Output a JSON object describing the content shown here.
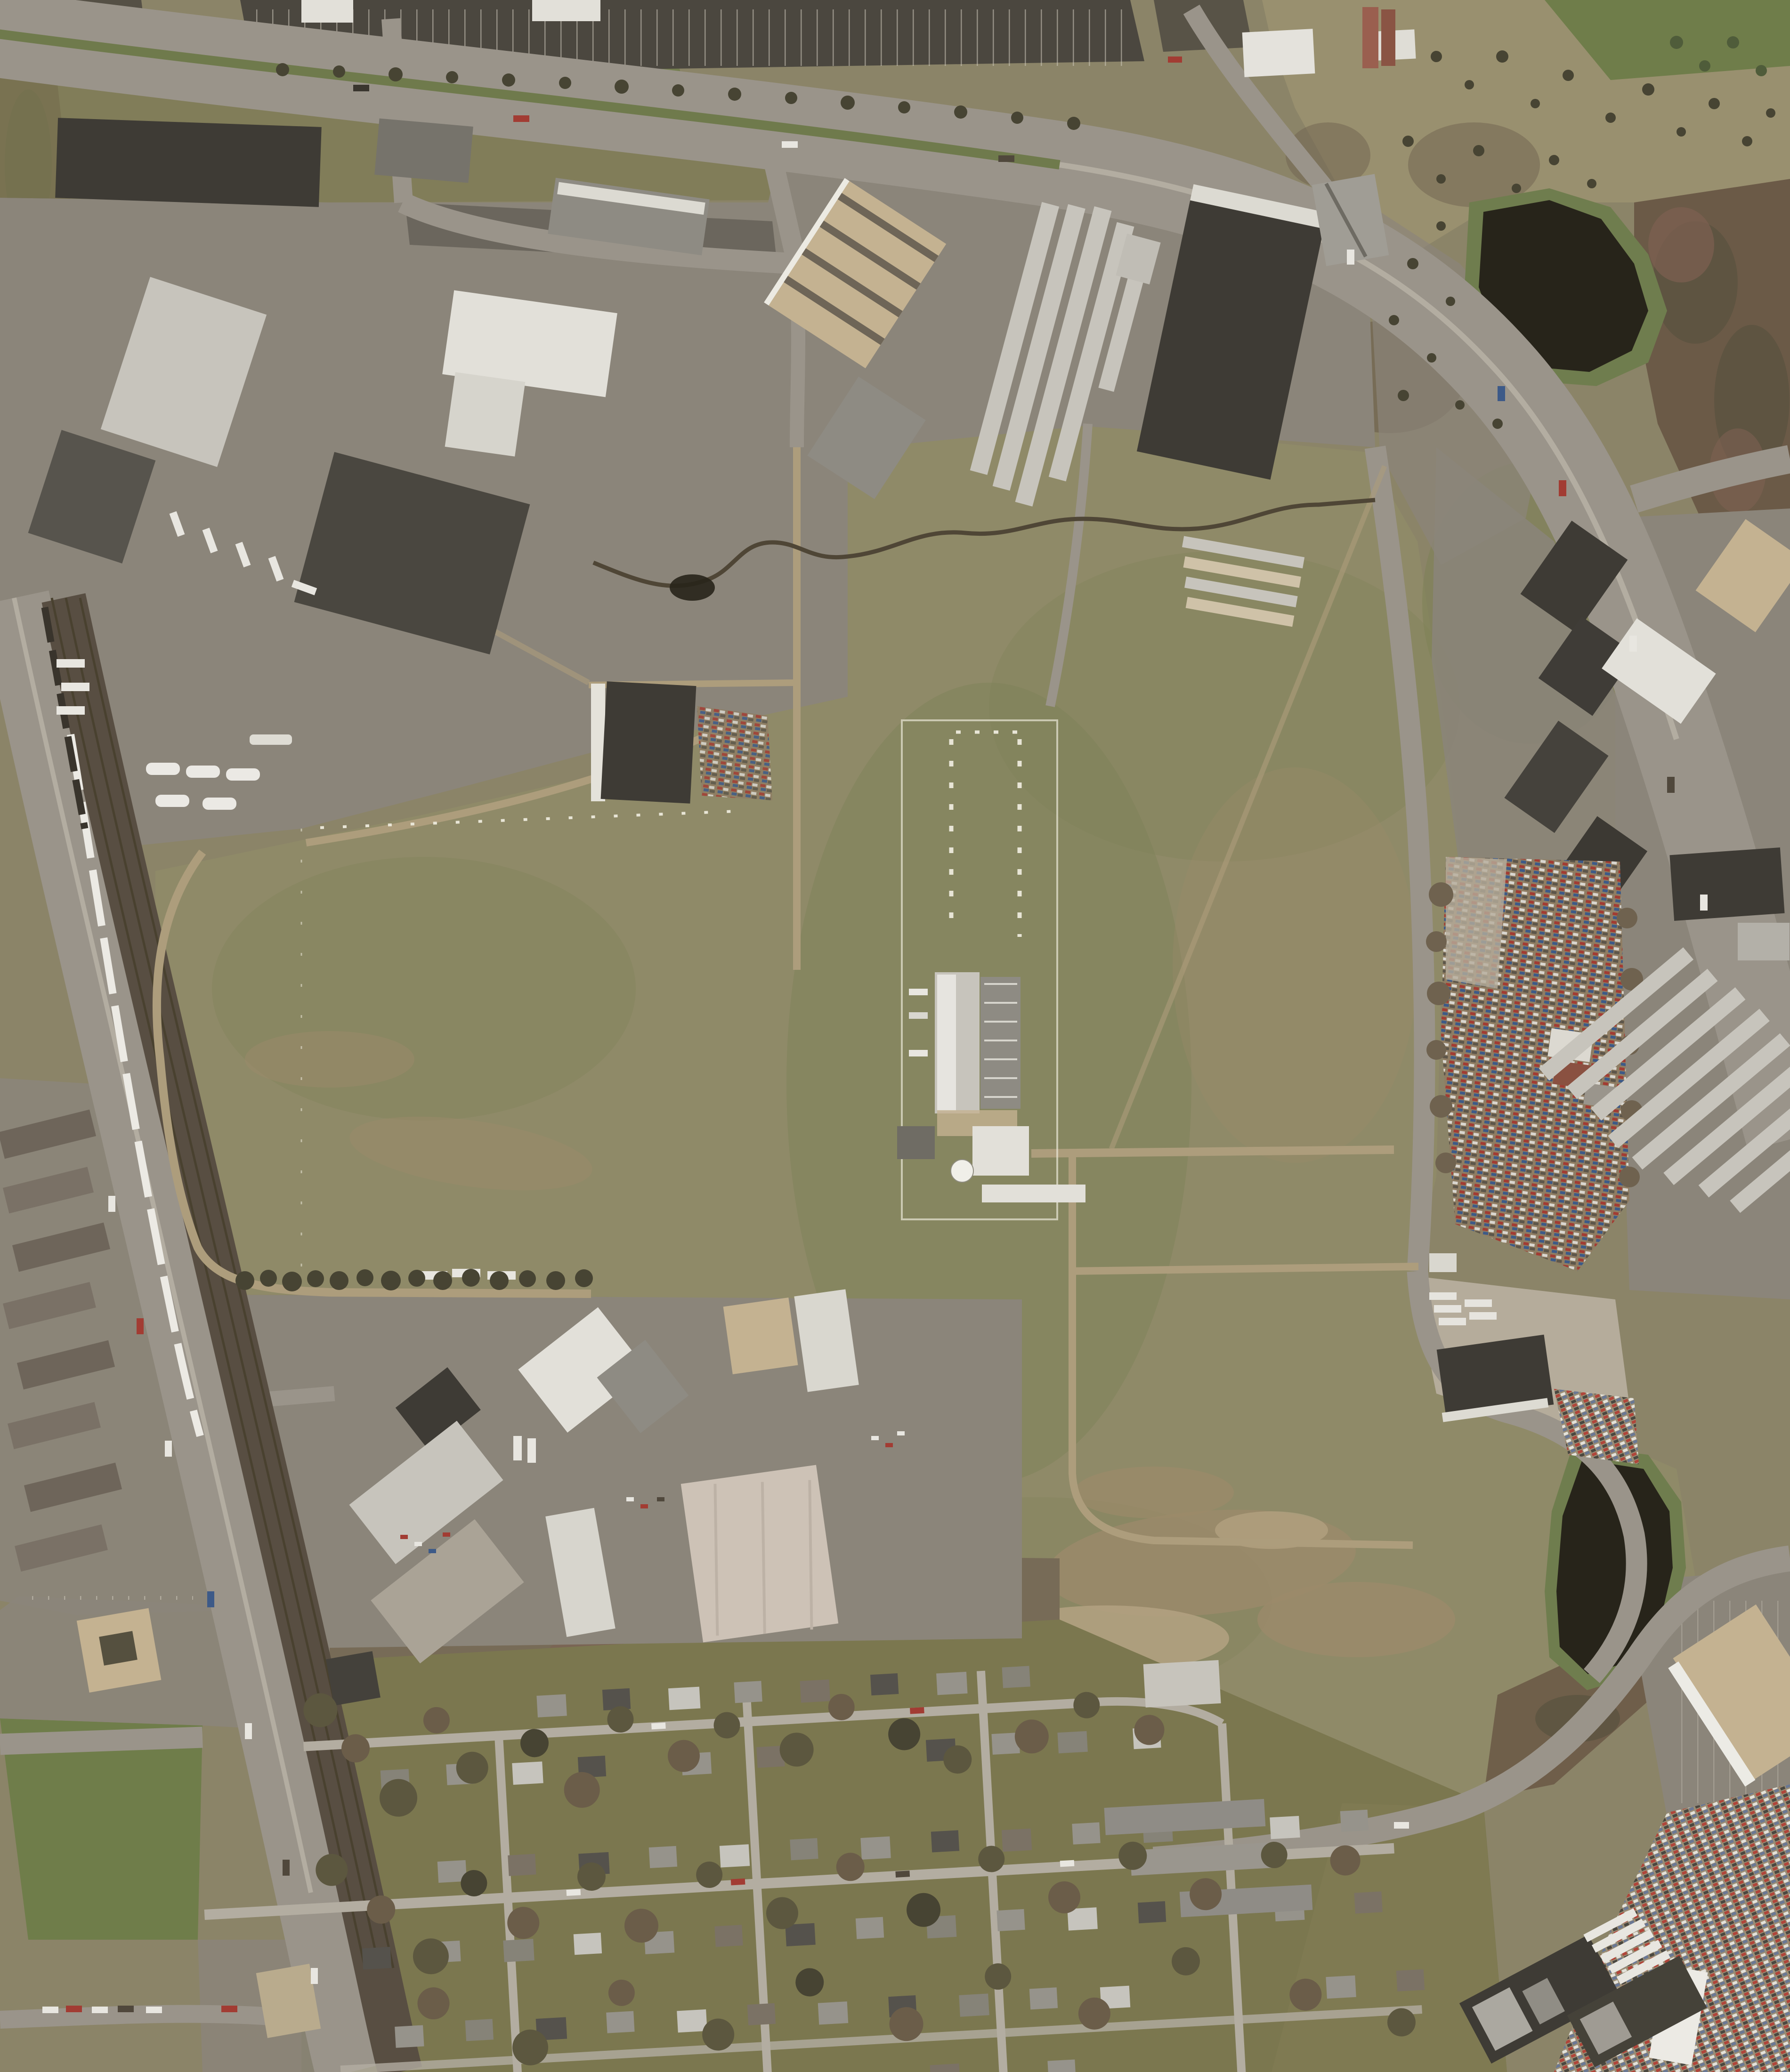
{
  "image": {
    "type": "aerial-orthophoto",
    "description": "Leaf-off spring aerial photograph of a suburban industrial corridor: a large olive-tan open field with mowed paths and a fenced utility facility at its center, warehouse and truck-yard districts to the northwest, a divided arterial highway running across the top and curving down the east side, a highway-and-railroad corridor with a white commuter train along the west edge, self-storage rows, an auto junkyard and two dark retention ponds on the east, and a single-family residential neighborhood with bare trees across the bottom."
  },
  "palette": {
    "ground": "#8b8468",
    "field": "#8f8a68",
    "field_green": "#7d8156",
    "dirt": "#9b8a6a",
    "dirt_light": "#ad9d7c",
    "grass": "#6f7d4a",
    "verge": "#7e7b54",
    "scrub": "#99906f",
    "woods": "#6f624f",
    "woods_dark": "#55503e",
    "forest": "#6b5a47",
    "water": "#27241a",
    "pond_ring": "#6f7d4e",
    "road": "#9a948a",
    "road_light": "#b3ada1",
    "asphalt": "#6e6960",
    "lot_dark": "#4b473f",
    "lot_gray": "#8b857a",
    "gravel": "#b5ac9b",
    "rail": "#584e42",
    "rail_tie": "#49412f",
    "train": "#eceae4",
    "median": "#6f7a4c",
    "roof_white": "#e2e0d9",
    "roof_silver": "#c7c4bc",
    "roof_gray": "#8e8b83",
    "roof_dark": "#3e3b35",
    "roof_tan": "#c4b291",
    "roof_pink": "#cdc2b6",
    "roof_brown": "#6e655a",
    "rust": "#8a5141",
    "tree": "#5c573f",
    "tree_dark": "#474433",
    "tree_red": "#7d6051",
    "creek": "#4f4636",
    "fence": "#e8e5d6",
    "car_red": "#a23c33",
    "car_white": "#e8e6e0",
    "car_blue": "#3d5a88"
  },
  "features": {
    "north_arterial_highway": "divided multi-lane arterial with grass median curving from top-left to the east edge",
    "west_corridor": "parallel highway and multi-track railroad with a white passenger train",
    "central_open_field": "large olive-tan field with mowed perimeter paths and interior lanes",
    "utility_facility": "fenced compound with twin pole rows, long white process building, dome tank",
    "creek": "dark meandering stream crossing the north of the field",
    "northwest_industrial_park": "warehouses, truck yards and a sawtooth-roof commercial building",
    "self_storage_complexes": "rows of long narrow storage buildings, northwest and east",
    "auto_junkyard": "dense multicolored scrapped-car rows on the east side",
    "retention_ponds": "two dark ponds ringed with green grass",
    "southeast_industrial": "large tan and dark warehouses with truck parking",
    "south_residential": "grid of small houses, lawns and bare trees",
    "west_apartments": "rows of long apartment blocks with parking lots"
  }
}
